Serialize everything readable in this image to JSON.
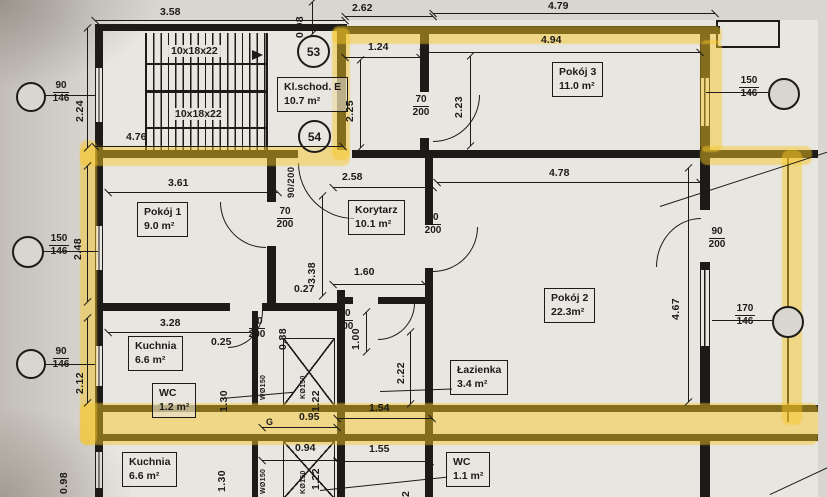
{
  "document": {
    "kind": "scanned architectural floor plan (photo with yellow highlighter)"
  },
  "rooms": [
    {
      "name": "Kl.schod. E",
      "area": "10.7 m²"
    },
    {
      "name": "Pokój 3",
      "area": "11.0 m²"
    },
    {
      "name": "Pokój 1",
      "area": "9.0 m²"
    },
    {
      "name": "Korytarz",
      "area": "10.1 m²"
    },
    {
      "name": "Pokój 2",
      "area": "22.3m²"
    },
    {
      "name": "Kuchnia",
      "area": "6.6 m²"
    },
    {
      "name": "WC",
      "area": "1.2 m²"
    },
    {
      "name": "Łazienka",
      "area": "3.4 m²"
    },
    {
      "name": "Kuchnia",
      "area": "6.6 m²"
    },
    {
      "name": "WC",
      "area": "1.1 m²"
    }
  ],
  "units": [
    "53",
    "54"
  ],
  "stairs": {
    "label": "10x18x22"
  },
  "doors": [
    {
      "w": "70",
      "h": "200",
      "label": "70/200"
    },
    {
      "w": "90",
      "h": "200",
      "label": "90/200"
    },
    {
      "w": "70",
      "h": "200",
      "label": "70/200"
    },
    {
      "w": "80",
      "h": "200",
      "label": "80/200"
    },
    {
      "w": "90",
      "h": "200",
      "label": "90/200"
    },
    {
      "w": "70",
      "h": "200",
      "label": "70/200"
    },
    {
      "w": "70",
      "h": "200",
      "label": "70/200"
    }
  ],
  "windows": [
    {
      "size": "90",
      "sill": "146"
    },
    {
      "size": "150",
      "sill": "146"
    },
    {
      "size": "90",
      "sill": "146"
    },
    {
      "size": "150",
      "sill": "146"
    },
    {
      "size": "170",
      "sill": "146"
    }
  ],
  "dims_h": [
    "3.58",
    "2.62",
    "4.79",
    "1.24",
    "4.94",
    "4.76",
    "3.61",
    "2.58",
    "4.78",
    "1.60",
    "0.27",
    "3.28",
    "0.25",
    "1.54",
    "0.95",
    "0.94",
    "1.55"
  ],
  "dims_v": [
    "2.24",
    "0.98",
    "2.25",
    "2.23",
    "2.48",
    "3.38",
    "4.67",
    "2.12",
    "0.88",
    "1.00",
    "2.22",
    "1.30",
    "1.22",
    "1.30",
    "1.22",
    "0.98",
    "2"
  ],
  "shafts": {
    "w": "WØ150",
    "k": "KØ150",
    "g": "G"
  },
  "colors": {
    "highlight": "#f5c324",
    "paper": "#d9d6d1",
    "ink": "#1d1b18"
  }
}
